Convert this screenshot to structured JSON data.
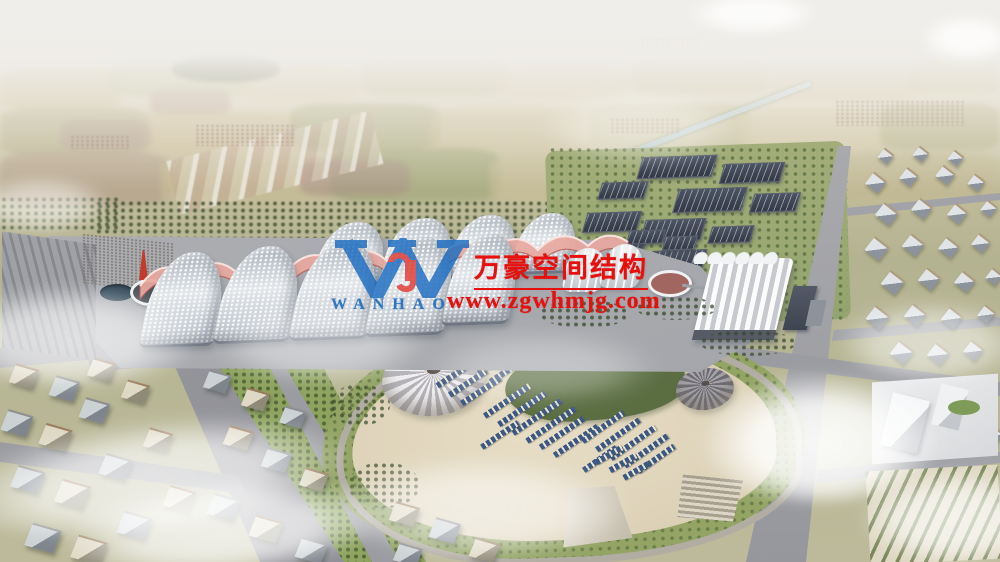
{
  "scene": {
    "description": "Aerial architectural rendering of a large exhibition center: rows of wave-roofed halls with pink fabric canopies, a white sawtooth annex, dark solar-panel farm, a landscaped park with two radial canopy tents and rows of blue panels, surrounding city blocks, farmland haze at the horizon and scattered clouds",
    "type": "architectural-rendering"
  },
  "watermark": {
    "company_name": "万豪空间结构",
    "website": "www.zgwhmjg.com",
    "logo_letter": "W",
    "logo_monogram": "hj",
    "logo_wordmark": "WANHAO",
    "text_color": "#e8100c",
    "logo_blue": "#1b6cc1",
    "logo_red": "#e03a33"
  }
}
